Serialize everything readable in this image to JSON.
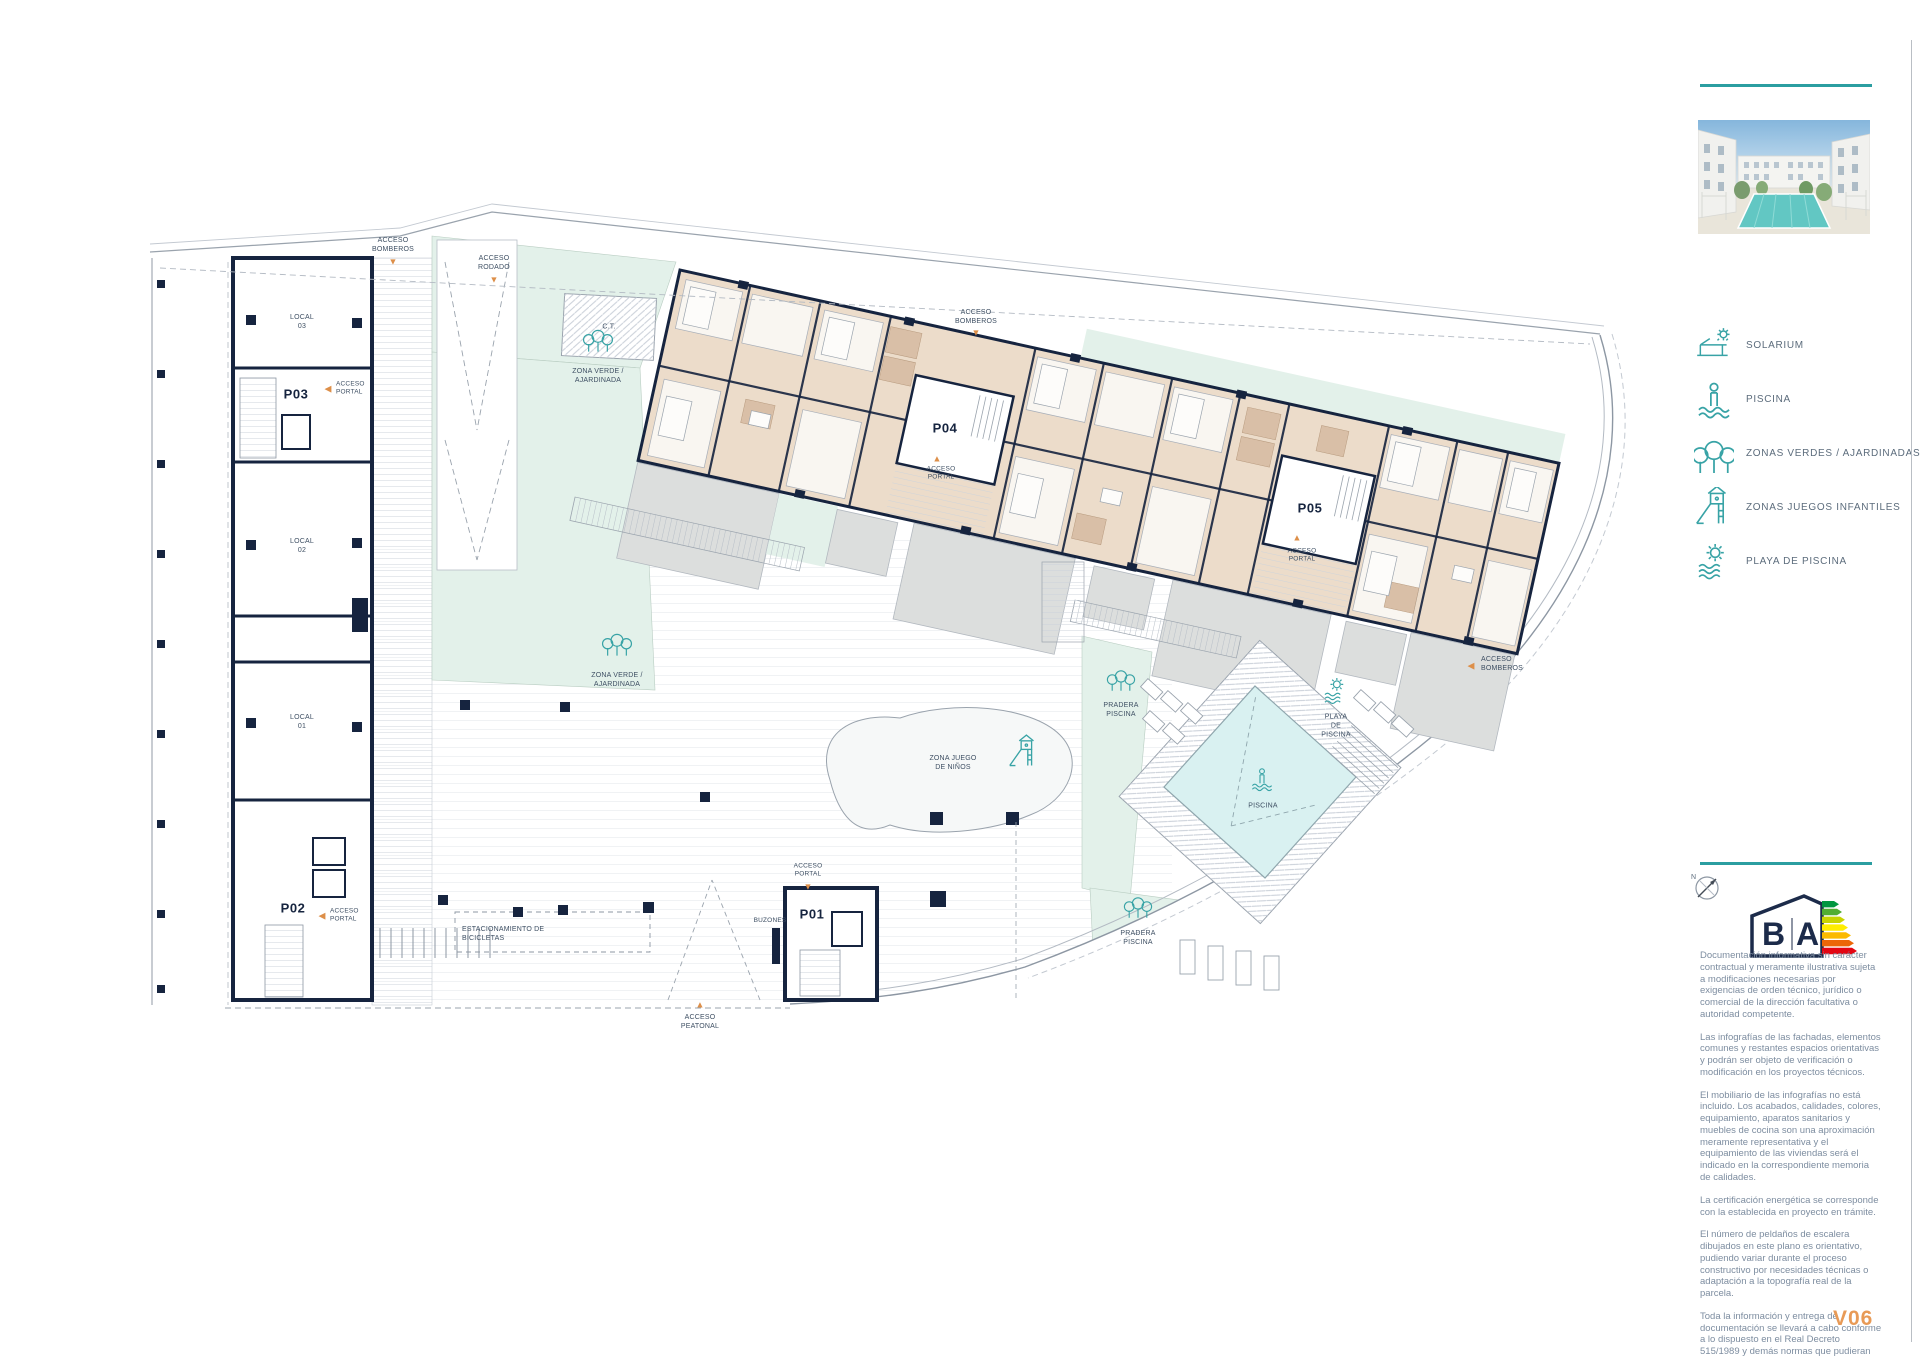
{
  "page": {
    "version": "V06"
  },
  "sidebar": {
    "legend": [
      {
        "icon": "solarium-icon",
        "label": "SOLARIUM"
      },
      {
        "icon": "piscina-icon",
        "label": "PISCINA"
      },
      {
        "icon": "zonas-verdes-icon",
        "label": "ZONAS VERDES / AJARDINADAS"
      },
      {
        "icon": "juegos-infantiles-icon",
        "label": "ZONAS JUEGOS INFANTILES"
      },
      {
        "icon": "playa-piscina-icon",
        "label": "PLAYA DE PISCINA"
      }
    ],
    "energy": {
      "letter_b": "B",
      "letter_a": "A",
      "bar_colors": [
        "#009640",
        "#52ae32",
        "#c8d400",
        "#ffed00",
        "#fbba00",
        "#ec6608",
        "#e30613"
      ]
    },
    "compass": "N",
    "disclaimer": [
      "Documentación informativa sin carácter contractual y meramente ilustrativa sujeta a modificaciones necesarias por exigencias de orden técnico, jurídico o comercial de la dirección facultativa o autoridad competente.",
      "Las infografías de las fachadas, elementos comunes y restantes espacios orientativas y podrán ser objeto de verificación o modificación en los proyectos técnicos.",
      "El mobiliario de las infografías no está incluido. Los acabados, calidades, colores, equipamiento, aparatos sanitarios y muebles de cocina son una aproximación meramente representativa y el equipamiento de las viviendas será el indicado en la correspondiente memoria de calidades.",
      "La certificación energética se corresponde con la establecida en proyecto en trámite.",
      "El número de peldaños de escalera dibujados en este plano es orientativo, pudiendo variar durante el proceso constructivo por necesidades técnicas o adaptación a la topografía real de la parcela.",
      "Toda la información y entrega de documentación se llevará a cabo conforme a lo dispuesto en el Real Decreto 515/1989 y demás normas que pudieran complementarlo ya sean de carácter estatal o autonómico."
    ]
  },
  "plan": {
    "portals": {
      "p01": "P01",
      "p02": "P02",
      "p03": "P03",
      "p04": "P04",
      "p05": "P05"
    },
    "locals": {
      "l01": "LOCAL\n01",
      "l02": "LOCAL\n02",
      "l03": "LOCAL\n03"
    },
    "labels": {
      "acceso_rodado": "ACCESO\nRODADO",
      "acceso_bomberos": "ACCESO\nBOMBEROS",
      "acceso_peatonal": "ACCESO\nPEATONAL",
      "acceso_portal": "ACCESO\nPORTAL",
      "ct": "C.T.",
      "zona_verde": "ZONA VERDE /\nAJARDINADA",
      "zona_juego": "ZONA JUEGO\nDE NIÑOS",
      "pradera_piscina": "PRADERA\nPISCINA",
      "playa_piscina": "PLAYA\nDE\nPISCINA",
      "piscina": "PISCINA",
      "bicicletas": "ESTACIONAMIENTO DE\nBICICLETAS",
      "buzones": "BUZONES"
    }
  },
  "colors": {
    "teal": "#2b9ea1",
    "navy": "#16243f",
    "accent_orange": "#e0944e",
    "apartment_beige": "#ecdcca",
    "bath_tan": "#d9bfa7",
    "green_zone": "#e3f1ea",
    "pool_cyan": "#d9f1f1",
    "terrace_gray": "#dcdedd"
  }
}
